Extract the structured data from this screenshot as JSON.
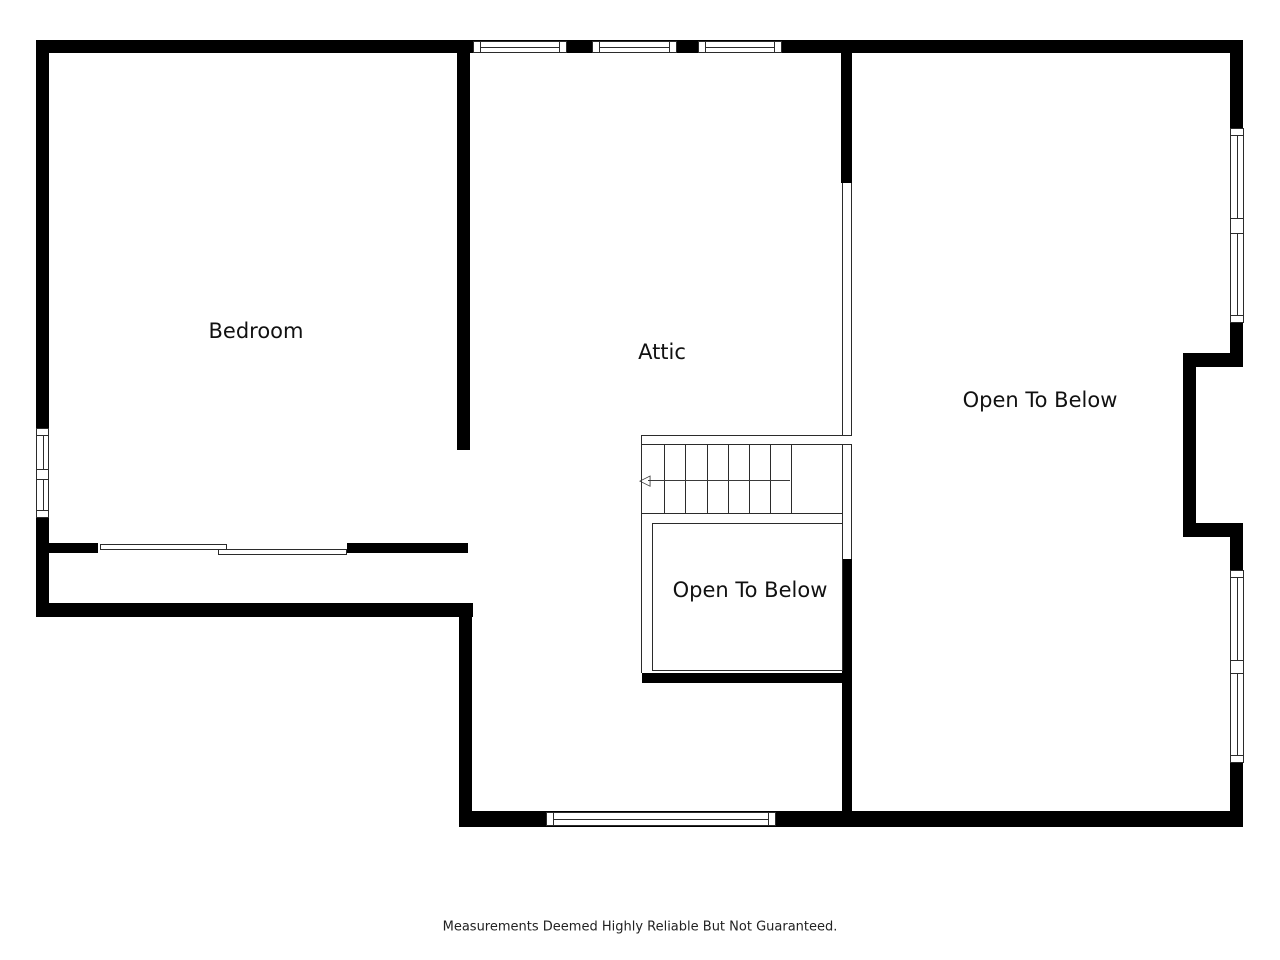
{
  "page": {
    "footer_note": "Measurements Deemed Highly Reliable But Not Guaranteed."
  },
  "floor_plan": {
    "rooms": [
      {
        "id": "bedroom",
        "label": "Bedroom"
      },
      {
        "id": "attic",
        "label": "Attic"
      },
      {
        "id": "open-to-below-right",
        "label": "Open To Below"
      },
      {
        "id": "open-to-below-center",
        "label": "Open To Below"
      }
    ],
    "stairs": {
      "up_arrow_glyph": "◁",
      "tread_count": 7
    },
    "colors": {
      "wall": "#000000",
      "line": "#2b2b2b",
      "background": "#ffffff"
    }
  }
}
